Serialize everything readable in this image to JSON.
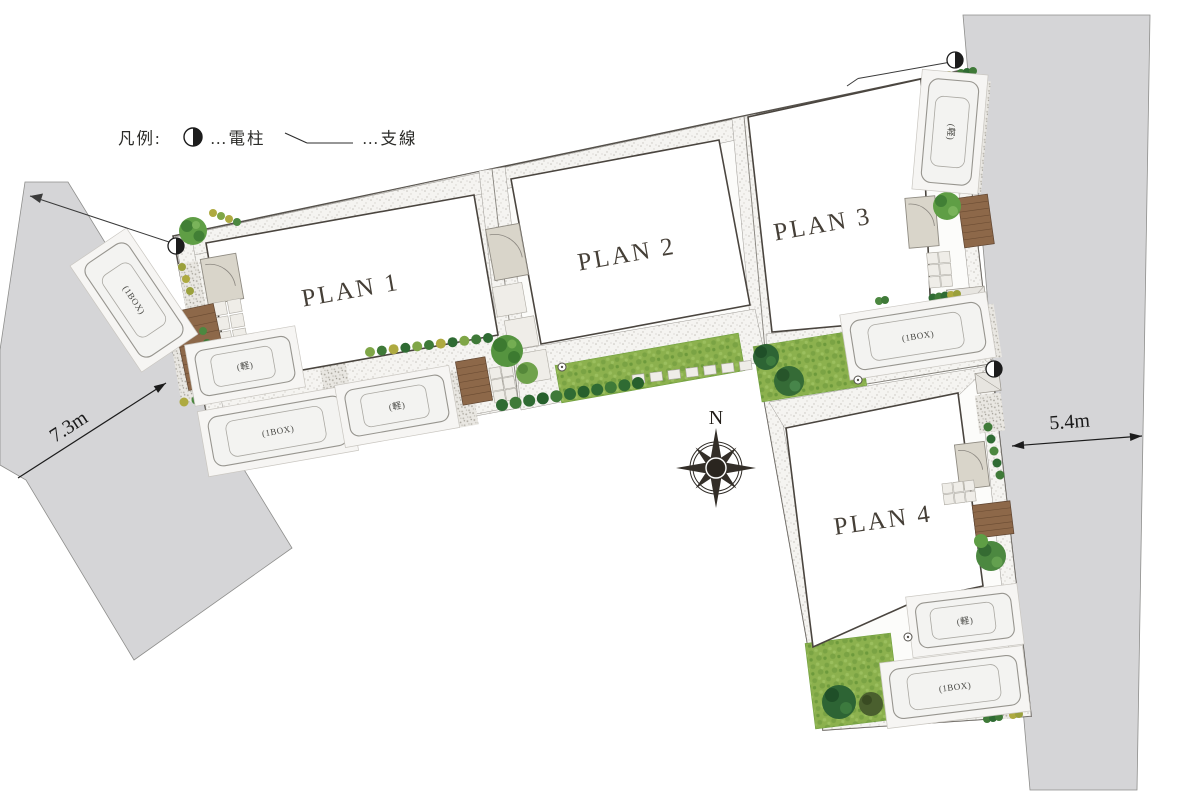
{
  "legend": {
    "title": "凡例:",
    "pole_label": "…電柱",
    "wire_label": "…支線"
  },
  "plans": {
    "p1": "PLAN 1",
    "p2": "PLAN 2",
    "p3": "PLAN 3",
    "p4": "PLAN 4"
  },
  "cars": {
    "west_box": "(1BOX)",
    "plan1_kei": "(軽)",
    "south_box": "(1BOX)",
    "south_kei": "(軽)",
    "plan3_kei": "(軽)",
    "plan3_box": "(1BOX)",
    "plan4_kei": "(軽)",
    "plan4_box": "(1BOX)"
  },
  "dimensions": {
    "west_road": "7.3m",
    "east_road": "5.4m"
  },
  "compass": {
    "north": "N"
  },
  "colors": {
    "road": "#d5d5d7",
    "lawn": "#8cb14e",
    "deck": "#8d6849",
    "tree_dark": "#2d6434",
    "tree_bright": "#5f9e45"
  }
}
